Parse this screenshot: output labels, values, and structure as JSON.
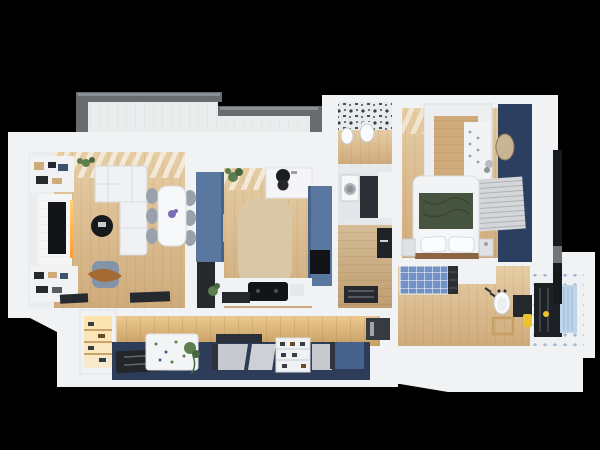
{
  "scene": {
    "title": "3D rendered apartment floor plan, top-down cutaway view on a black background",
    "type": "3d-floor-plan-render",
    "rooms": [
      {
        "id": "balcony",
        "label": "balcony with gray parapet"
      },
      {
        "id": "living-room",
        "label": "living room with white corner sofa, TV wall, dining table"
      },
      {
        "id": "kitchen",
        "label": "kitchen with slate-blue cabinets and marble counter"
      },
      {
        "id": "wc",
        "label": "small WC with patterned tile floor, toilet and bidet"
      },
      {
        "id": "utility",
        "label": "utility alcove with washing machine"
      },
      {
        "id": "corridor",
        "label": "inner corridor with wood floor"
      },
      {
        "id": "bedroom",
        "label": "bedroom with navy accent wall, bed with green throw, wardrobe"
      },
      {
        "id": "bathroom",
        "label": "bathroom with shower, blue tiled tub, sink and mirror"
      },
      {
        "id": "hallway",
        "label": "entry hallway with navy floor, lit closet, shoe rack and bench"
      }
    ]
  },
  "colors": {
    "background": "#000000",
    "wall": "#f1f2f4",
    "wall2": "#e6e8ea",
    "wood_light": "#e6cda4",
    "wood_dark": "#cfab7c",
    "wood_wall_light": "#ecc98f",
    "wood_wall_dark": "#c79f63",
    "balcony_gray": "#676c70",
    "balcony_gray_light": "#8b9094",
    "balcony_floor": "#eaecee",
    "blue_cab": "#59779f",
    "blue_cab_dark": "#47638a",
    "navy_wall": "#2d3f60",
    "navy_floor": "#2c3c59",
    "mat_dark": "#26292e",
    "screen_black": "#121417",
    "sofa": "#eff1f3",
    "chair": "#99a2ab",
    "rug_beige": "#d9c8a8",
    "pouf": "#8494a8",
    "throw": "#a46a31",
    "bed_green": "#47543f",
    "plant": "#5c7d4e",
    "curtain_blue": "#bcd3e8",
    "check_blue": "#7291c4",
    "accent_yellow": "#eec32d",
    "led_top": "#ffd27a",
    "led_bottom": "#ff9b2e",
    "glow_warm": "#ffe3ab",
    "steel": "#b9bdc2",
    "mirror_dark": "#24272c",
    "mirror_glass": "#c9b594",
    "headboard_wood": "#8a6540",
    "flower_purple": "#7b6bb5"
  }
}
